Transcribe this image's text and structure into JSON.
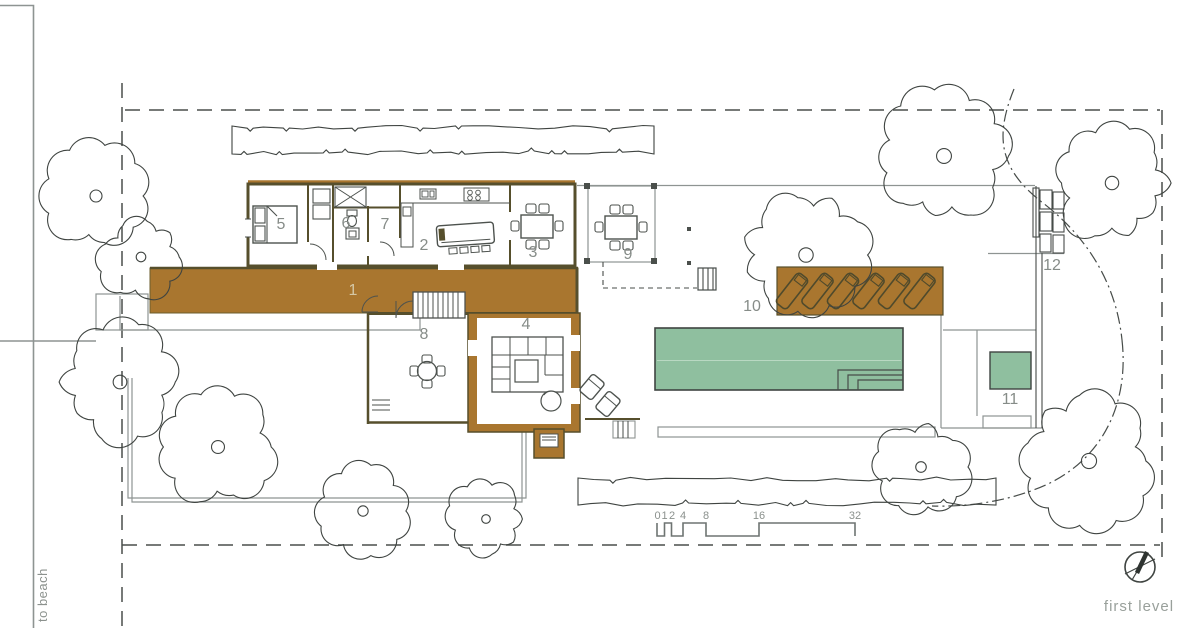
{
  "plan": {
    "room_numbers": [
      "1",
      "2",
      "3",
      "4",
      "5",
      "6",
      "7",
      "8",
      "9",
      "10",
      "11",
      "12"
    ],
    "scale_ticks": [
      "0",
      "1",
      "2",
      "4",
      "8",
      "16",
      "32"
    ],
    "labels": {
      "to_beach": "to beach",
      "level": "first level"
    },
    "colors": {
      "deck_brown": "#a9762f",
      "pool_green": "#8fbf9f",
      "wall_olive": "#564f2c",
      "line_dark": "#4a4f4b",
      "muted_text": "#8b918d"
    }
  }
}
